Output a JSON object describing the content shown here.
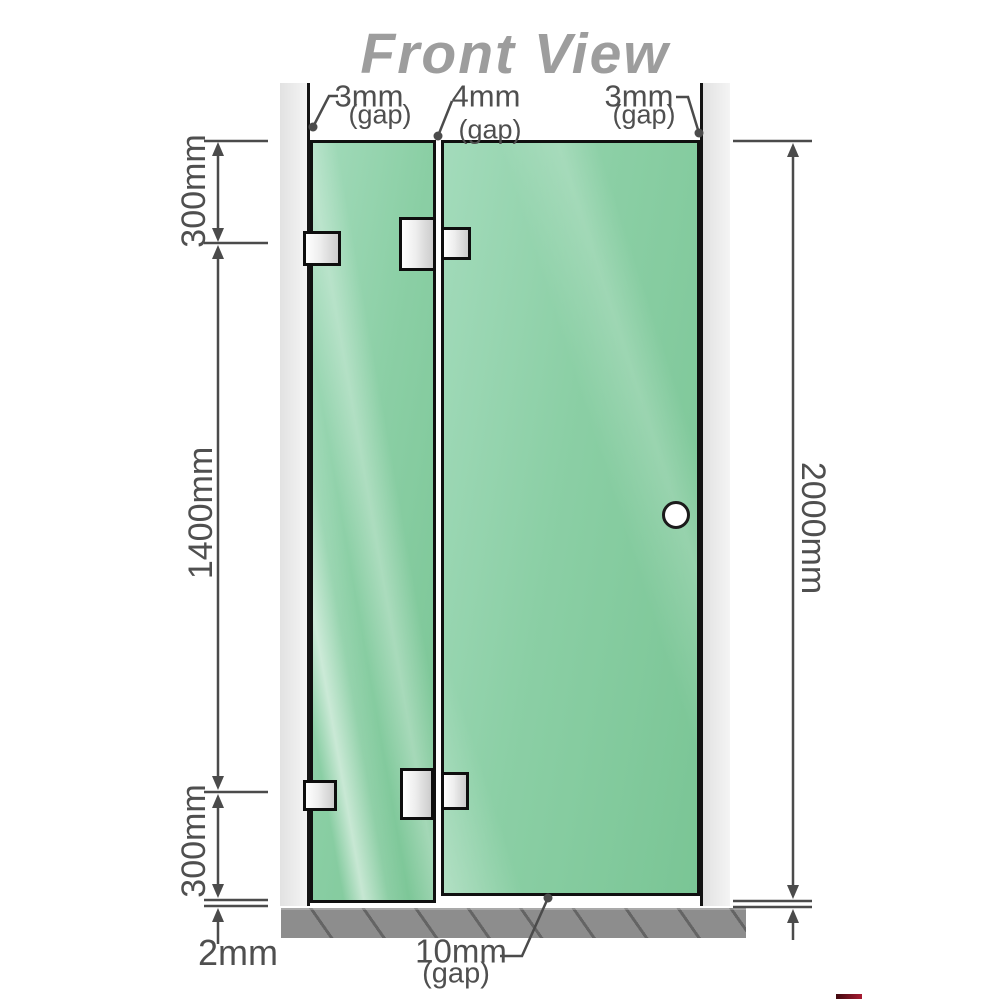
{
  "title": "Front View",
  "annotations": {
    "top_gaps": [
      {
        "value": "3mm",
        "note": "(gap)"
      },
      {
        "value": "4mm",
        "note": "(gap)"
      },
      {
        "value": "3mm",
        "note": "(gap)"
      }
    ],
    "left": {
      "top_section": "300mm",
      "middle_section": "1400mm",
      "bottom_section": "300mm",
      "floor_gap": "2mm"
    },
    "right": {
      "total_height": "2000mm"
    },
    "bottom_gap": {
      "value": "10mm",
      "note": "(gap)"
    }
  },
  "colors": {
    "glass_green": "#8bcfa5",
    "wall_gray": "#e9e9e9",
    "floor_gray": "#8d8d8d",
    "dimension_gray": "#4b4b4b",
    "title_gray": "#9d9d9d"
  }
}
